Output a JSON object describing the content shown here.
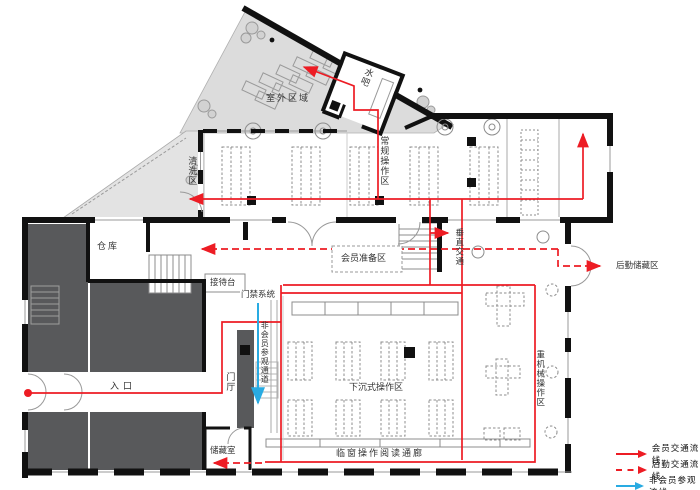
{
  "plan": {
    "labels": {
      "outdoor_area": "室外区域",
      "water_bar": "水吧",
      "cleaning_area": "清洗区",
      "regular_ops_area": "常规操作区",
      "warehouse": "仓库",
      "reception_desk": "接待台",
      "member_prep_area": "会员准备区",
      "vertical_circulation": "垂直交通",
      "logistics_storage_area": "后勤储藏区",
      "access_control": "门禁系统",
      "non_member_passage": "非会员参观通道",
      "entrance": "入口",
      "foyer": "门厅",
      "sunken_ops_area": "下沉式操作区",
      "heavy_machinery_area": "重机械操作区",
      "storage_room": "储藏室",
      "window_reading_corridor": "临窗操作阅读通廊"
    }
  },
  "legend": {
    "items": [
      {
        "label": "会员交通流线",
        "line_style": "solid",
        "color": "#ed1c24"
      },
      {
        "label": "后勤交通流线",
        "line_style": "dashed",
        "color": "#ed1c24"
      },
      {
        "label": "非会员参观流线",
        "line_style": "solid",
        "color": "#29abe2"
      }
    ]
  },
  "colors": {
    "member_flow": "#ed1c24",
    "logistics_flow": "#ed1c24",
    "visitor_flow": "#29abe2",
    "walls": "#111111",
    "back_of_house_fill": "#58595b",
    "outdoor_fill": "#dcdcdc"
  }
}
